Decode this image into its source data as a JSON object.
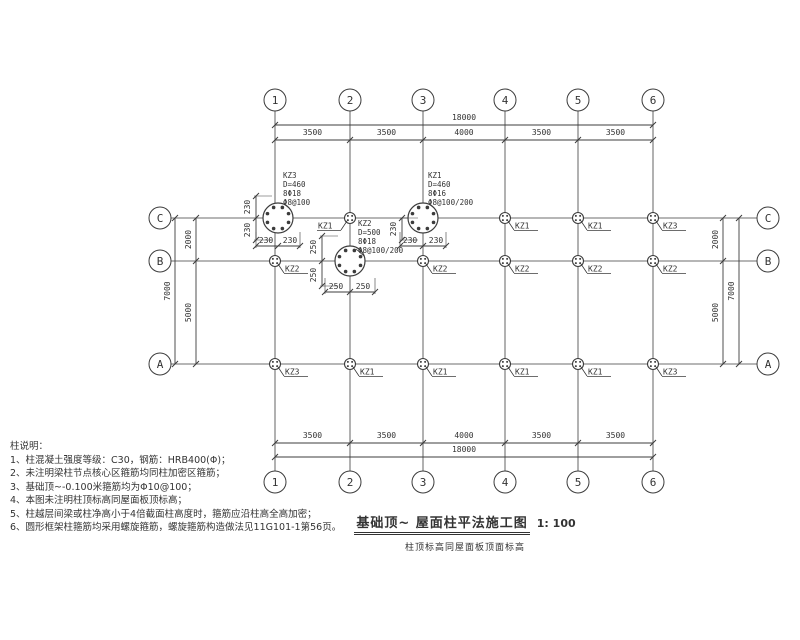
{
  "colors": {
    "ink": "#3c3c3c",
    "text": "#2e2e2e"
  },
  "titleblock": {
    "title": "基础顶~ 屋面柱平法施工图",
    "scale": "1: 100",
    "subtitle": "柱顶标高同屋面板顶面标高"
  },
  "notes": {
    "title": "柱说明：",
    "items": [
      "1、柱混凝土强度等级：C30，钢筋：HRB400(Φ)；",
      "2、未注明梁柱节点核心区箍筋均同柱加密区箍筋；",
      "3、基础顶~-0.100米箍筋均为Φ10@100；",
      "4、本图未注明柱顶标高同屋面板顶标高；",
      "5、柱越层间梁或柱净高小于4倍截面柱高度时，箍筋应沿柱高全高加密；",
      "6、圆形框架柱箍筋均采用螺旋箍筋，螺旋箍筋构造做法见11G101-1第56页。"
    ]
  },
  "plan": {
    "cols": [
      {
        "label": "1",
        "x": 275
      },
      {
        "label": "2",
        "x": 350
      },
      {
        "label": "3",
        "x": 423
      },
      {
        "label": "4",
        "x": 505
      },
      {
        "label": "5",
        "x": 578
      },
      {
        "label": "6",
        "x": 653
      }
    ],
    "rows": [
      {
        "label": "C",
        "y": 218
      },
      {
        "label": "B",
        "y": 261
      },
      {
        "label": "A",
        "y": 364
      }
    ],
    "dims": {
      "total_h": "18000",
      "top_segments": [
        "3500",
        "3500",
        "4000",
        "3500",
        "3500"
      ],
      "bottom_segments": [
        "3500",
        "3500",
        "4000",
        "3500",
        "3500"
      ],
      "total_v": "7000",
      "left_segments": [
        "2000",
        "5000"
      ],
      "right_segments": [
        "2000",
        "5000"
      ]
    },
    "columns": [
      {
        "x": 350,
        "y": 218,
        "label": "KZ1",
        "side": "left"
      },
      {
        "x": 505,
        "y": 218,
        "label": "KZ1",
        "side": "right"
      },
      {
        "x": 578,
        "y": 218,
        "label": "KZ1",
        "side": "right"
      },
      {
        "x": 653,
        "y": 218,
        "label": "KZ3",
        "side": "right"
      },
      {
        "x": 275,
        "y": 261,
        "label": "KZ2",
        "side": "right"
      },
      {
        "x": 423,
        "y": 261,
        "label": "KZ2",
        "side": "right"
      },
      {
        "x": 505,
        "y": 261,
        "label": "KZ2",
        "side": "right"
      },
      {
        "x": 578,
        "y": 261,
        "label": "KZ2",
        "side": "right"
      },
      {
        "x": 653,
        "y": 261,
        "label": "KZ2",
        "side": "right"
      },
      {
        "x": 275,
        "y": 364,
        "label": "KZ3",
        "side": "right"
      },
      {
        "x": 350,
        "y": 364,
        "label": "KZ1",
        "side": "right"
      },
      {
        "x": 423,
        "y": 364,
        "label": "KZ1",
        "side": "right"
      },
      {
        "x": 505,
        "y": 364,
        "label": "KZ1",
        "side": "right"
      },
      {
        "x": 578,
        "y": 364,
        "label": "KZ1",
        "side": "right"
      },
      {
        "x": 653,
        "y": 364,
        "label": "KZ3",
        "side": "right"
      }
    ],
    "details": [
      {
        "x": 278,
        "y": 218,
        "r": 15,
        "text": [
          "KZ3",
          "D=460",
          "8Φ18",
          "Φ8@100"
        ],
        "tx": 283,
        "ty": 172,
        "leader": [
          [
            289,
            208
          ],
          [
            284,
            204
          ]
        ],
        "vdim": {
          "x": 256,
          "ticks": [
            196,
            218,
            240
          ],
          "labels": [
            {
              "t": "230",
              "y": 207
            },
            {
              "t": "230",
              "y": 230
            }
          ]
        },
        "hdim": {
          "y": 246,
          "ticks": [
            256,
            278,
            300
          ],
          "labels": [
            {
              "t": "230",
              "x": 266
            },
            {
              "t": "230",
              "x": 290
            }
          ]
        }
      },
      {
        "x": 423,
        "y": 218,
        "r": 15,
        "text": [
          "KZ1",
          "D=460",
          "8Φ16",
          "Φ8@100/200"
        ],
        "tx": 428,
        "ty": 172,
        "leader": [
          [
            434,
            208
          ],
          [
            429,
            204
          ]
        ],
        "vdim": {
          "x": 402,
          "ticks": [
            218,
            240
          ],
          "labels": [
            {
              "t": "230",
              "y": 229
            }
          ]
        },
        "hdim": {
          "y": 246,
          "ticks": [
            400,
            423,
            446
          ],
          "labels": [
            {
              "t": "230",
              "x": 410
            },
            {
              "t": "230",
              "x": 436
            }
          ]
        }
      },
      {
        "x": 350,
        "y": 261,
        "r": 15,
        "text": [
          "KZ2",
          "D=500",
          "8Φ18",
          "Φ8@100/200"
        ],
        "tx": 358,
        "ty": 220,
        "leader": [
          [
            364,
            256
          ],
          [
            356,
            249
          ]
        ],
        "vdim": {
          "x": 322,
          "ticks": [
            236,
            261,
            286
          ],
          "labels": [
            {
              "t": "250",
              "y": 247
            },
            {
              "t": "250",
              "y": 275
            }
          ]
        },
        "hdim": {
          "y": 292,
          "ticks": [
            325,
            350,
            375
          ],
          "labels": [
            {
              "t": "250",
              "x": 336
            },
            {
              "t": "250",
              "x": 363
            }
          ]
        }
      }
    ]
  }
}
